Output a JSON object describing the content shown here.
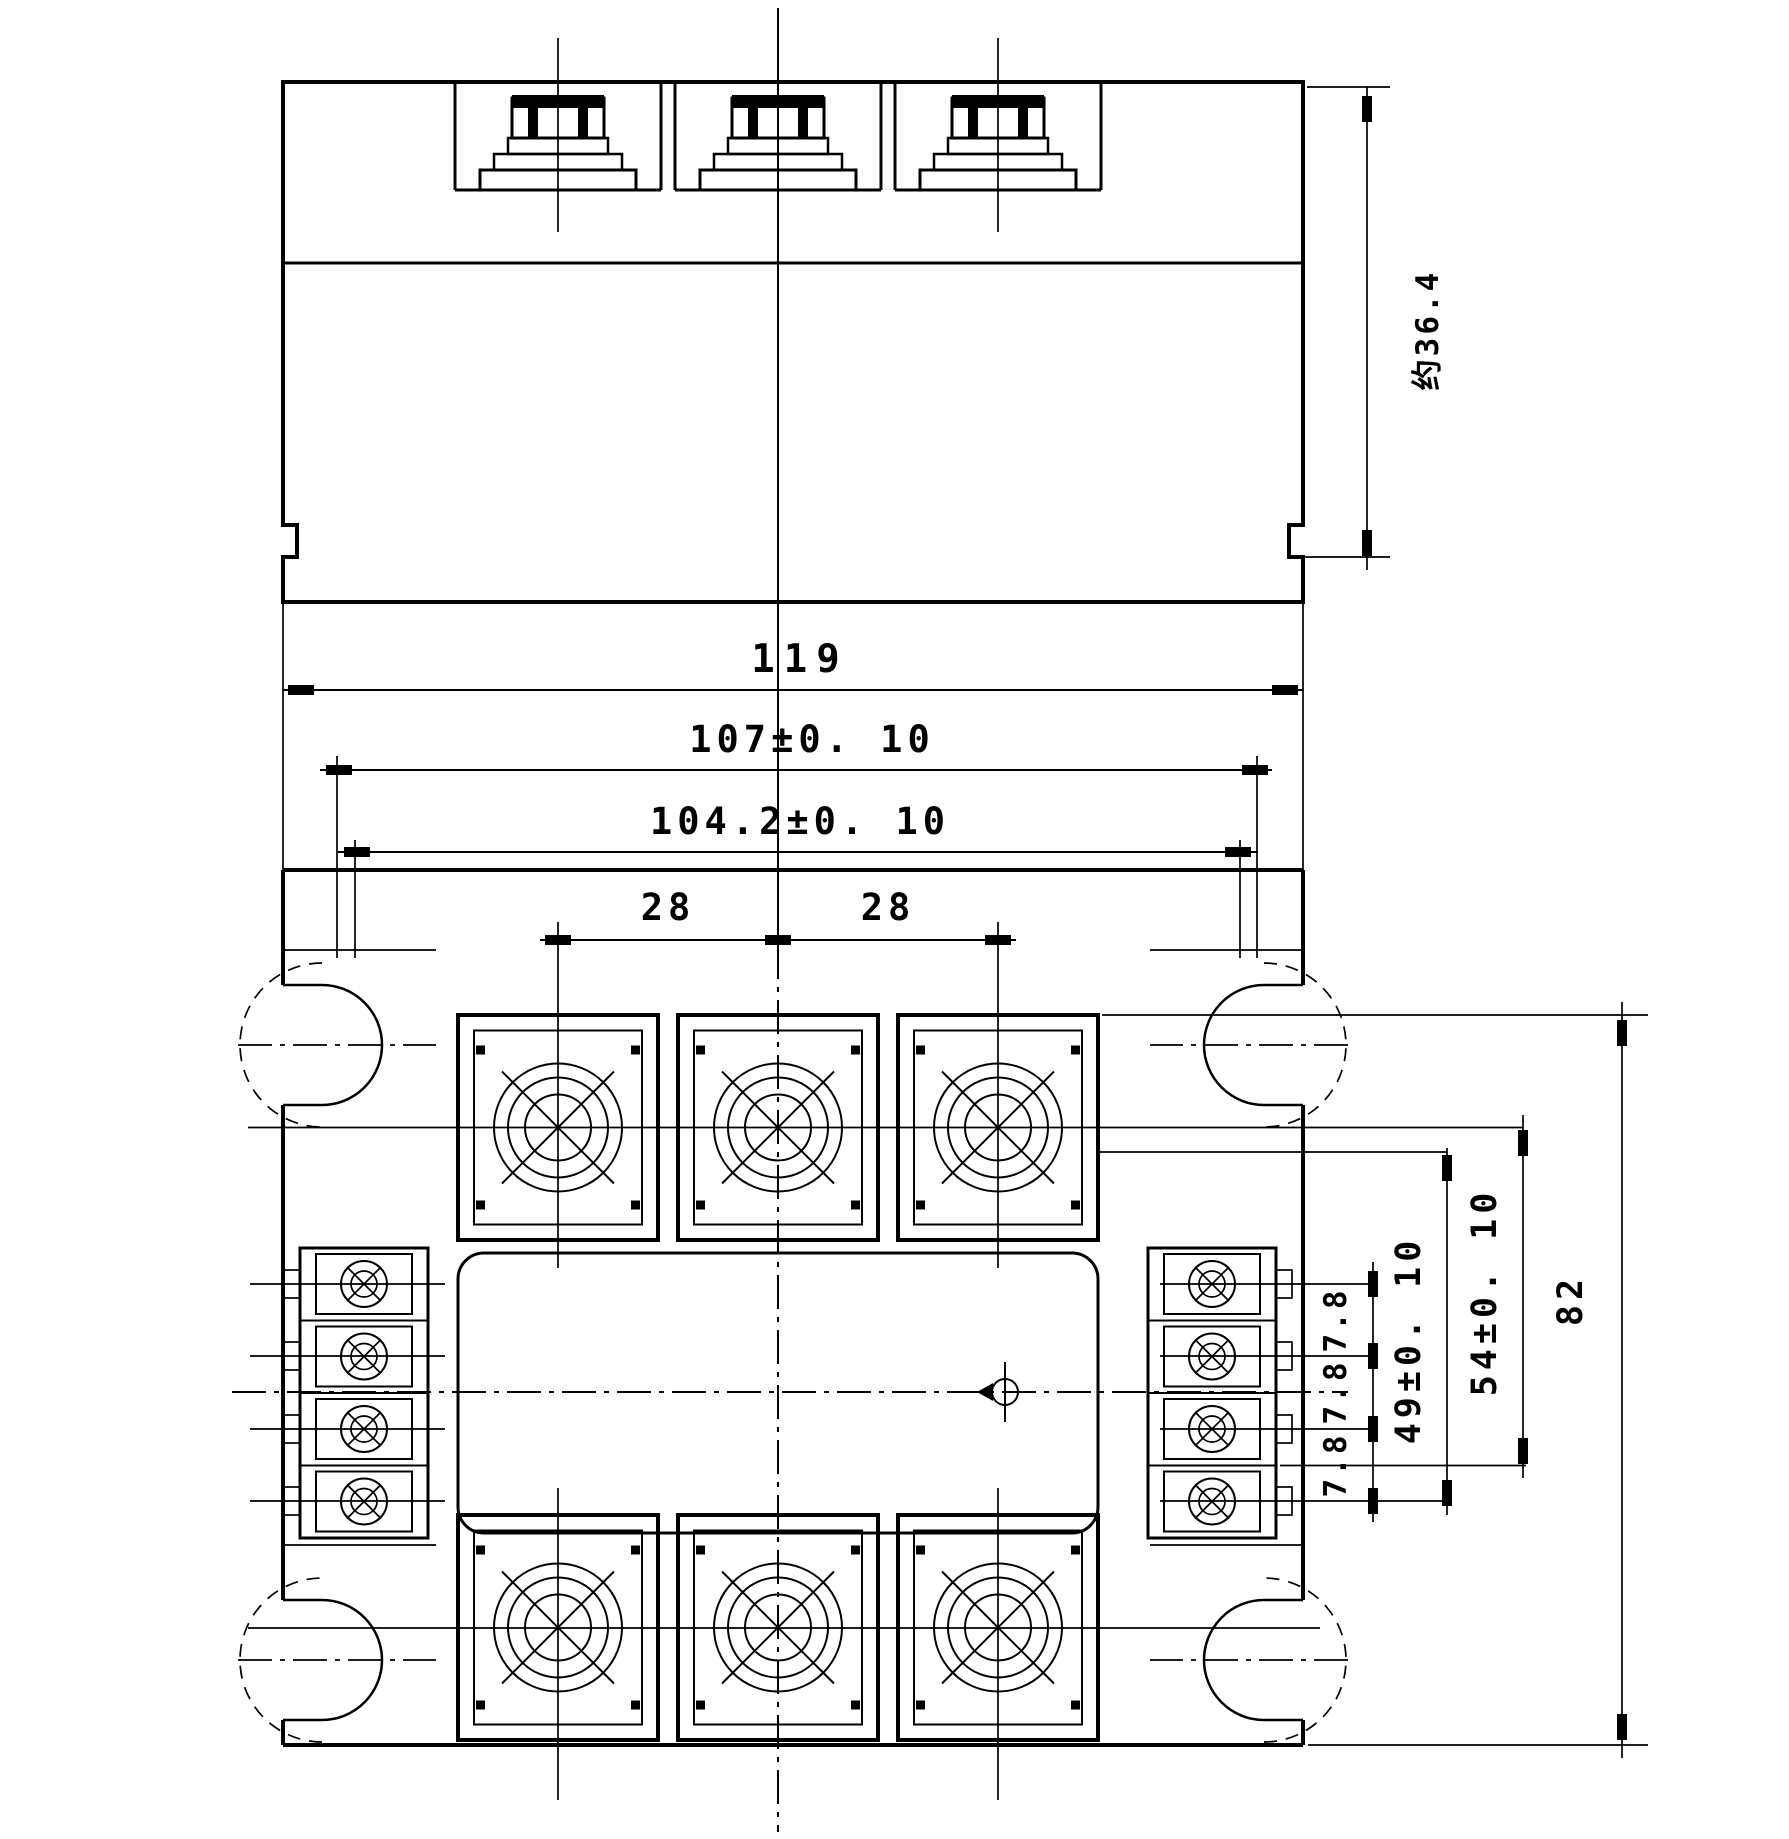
{
  "drawing": {
    "kind": "relay-module-dimension-drawing",
    "views": {
      "front": "front-view",
      "top": "top-view"
    },
    "dims": {
      "overall_width": "119",
      "hole_spacing": "107±0. 10",
      "inner_width": "104.2±0. 10",
      "pitch_left": "28",
      "pitch_right": "28",
      "height_approx": "约36.4",
      "ctrl_pitch": [
        "7.8",
        "7.8",
        "7.8"
      ],
      "row_49": "49±0. 10",
      "row_54": "54±0. 10",
      "overall_depth": "82"
    }
  }
}
